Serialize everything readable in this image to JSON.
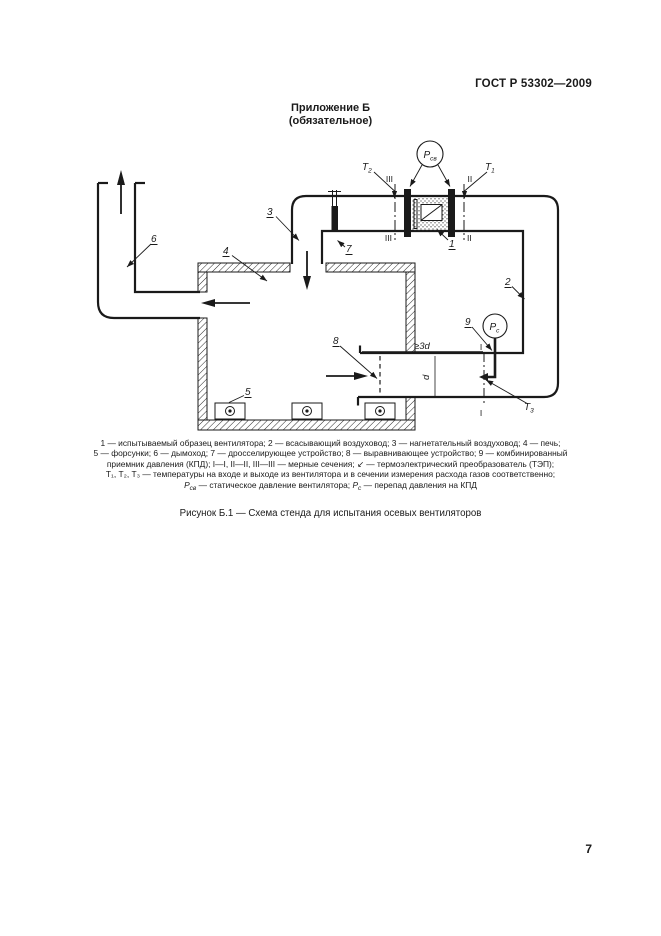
{
  "page": {
    "header": "ГОСТ Р 53302—2009",
    "page_number": "7"
  },
  "appendix": {
    "title": "Приложение Б",
    "subtitle": "(обязательное)"
  },
  "figure": {
    "caption": "Рисунок Б.1 — Схема стенда для испытания осевых вентиляторов",
    "legend": {
      "line1": "1 — испытываемый образец вентилятора; 2 — всасывающий воздуховод; 3 — нагнетательный воздуховод; 4 — печь;",
      "line2": "5 — форсунки; 6 — дымоход; 7 — дросселирующее устройство; 8 — выравнивающее устройство; 9 — комбинированный",
      "line3": "приемник давления (КПД); I—I, II—II, III—III — мерные сечения; ↙ — термоэлектрический преобразователь (ТЭП);",
      "line4": "Т₁, Т₂, Т₃ — температуры на входе и выходе из вентилятора и в сечении измерения расхода газов соответственно;",
      "line5": {
        "p1": "Р",
        "p1sub": "св",
        "p2": " — статическое давление вентилятора; ",
        "p3": "Р",
        "p3sub": "с",
        "p4": " — перепад давления на КПД"
      }
    },
    "diagram": {
      "numbers": {
        "n1": "1",
        "n2": "2",
        "n3": "3",
        "n4": "4",
        "n5": "5",
        "n6": "6",
        "n7": "7",
        "n8": "8",
        "n9": "9"
      },
      "temps": {
        "t": "T",
        "t1sub": "1",
        "t2sub": "2",
        "t3sub": "3"
      },
      "pressures": {
        "p": "P",
        "psv_sub": "св",
        "pc_sub": "с"
      },
      "sections": {
        "s1": "I",
        "s2": "II",
        "s3": "III"
      },
      "dims": {
        "length": "≥3d",
        "diameter": "d"
      }
    }
  }
}
